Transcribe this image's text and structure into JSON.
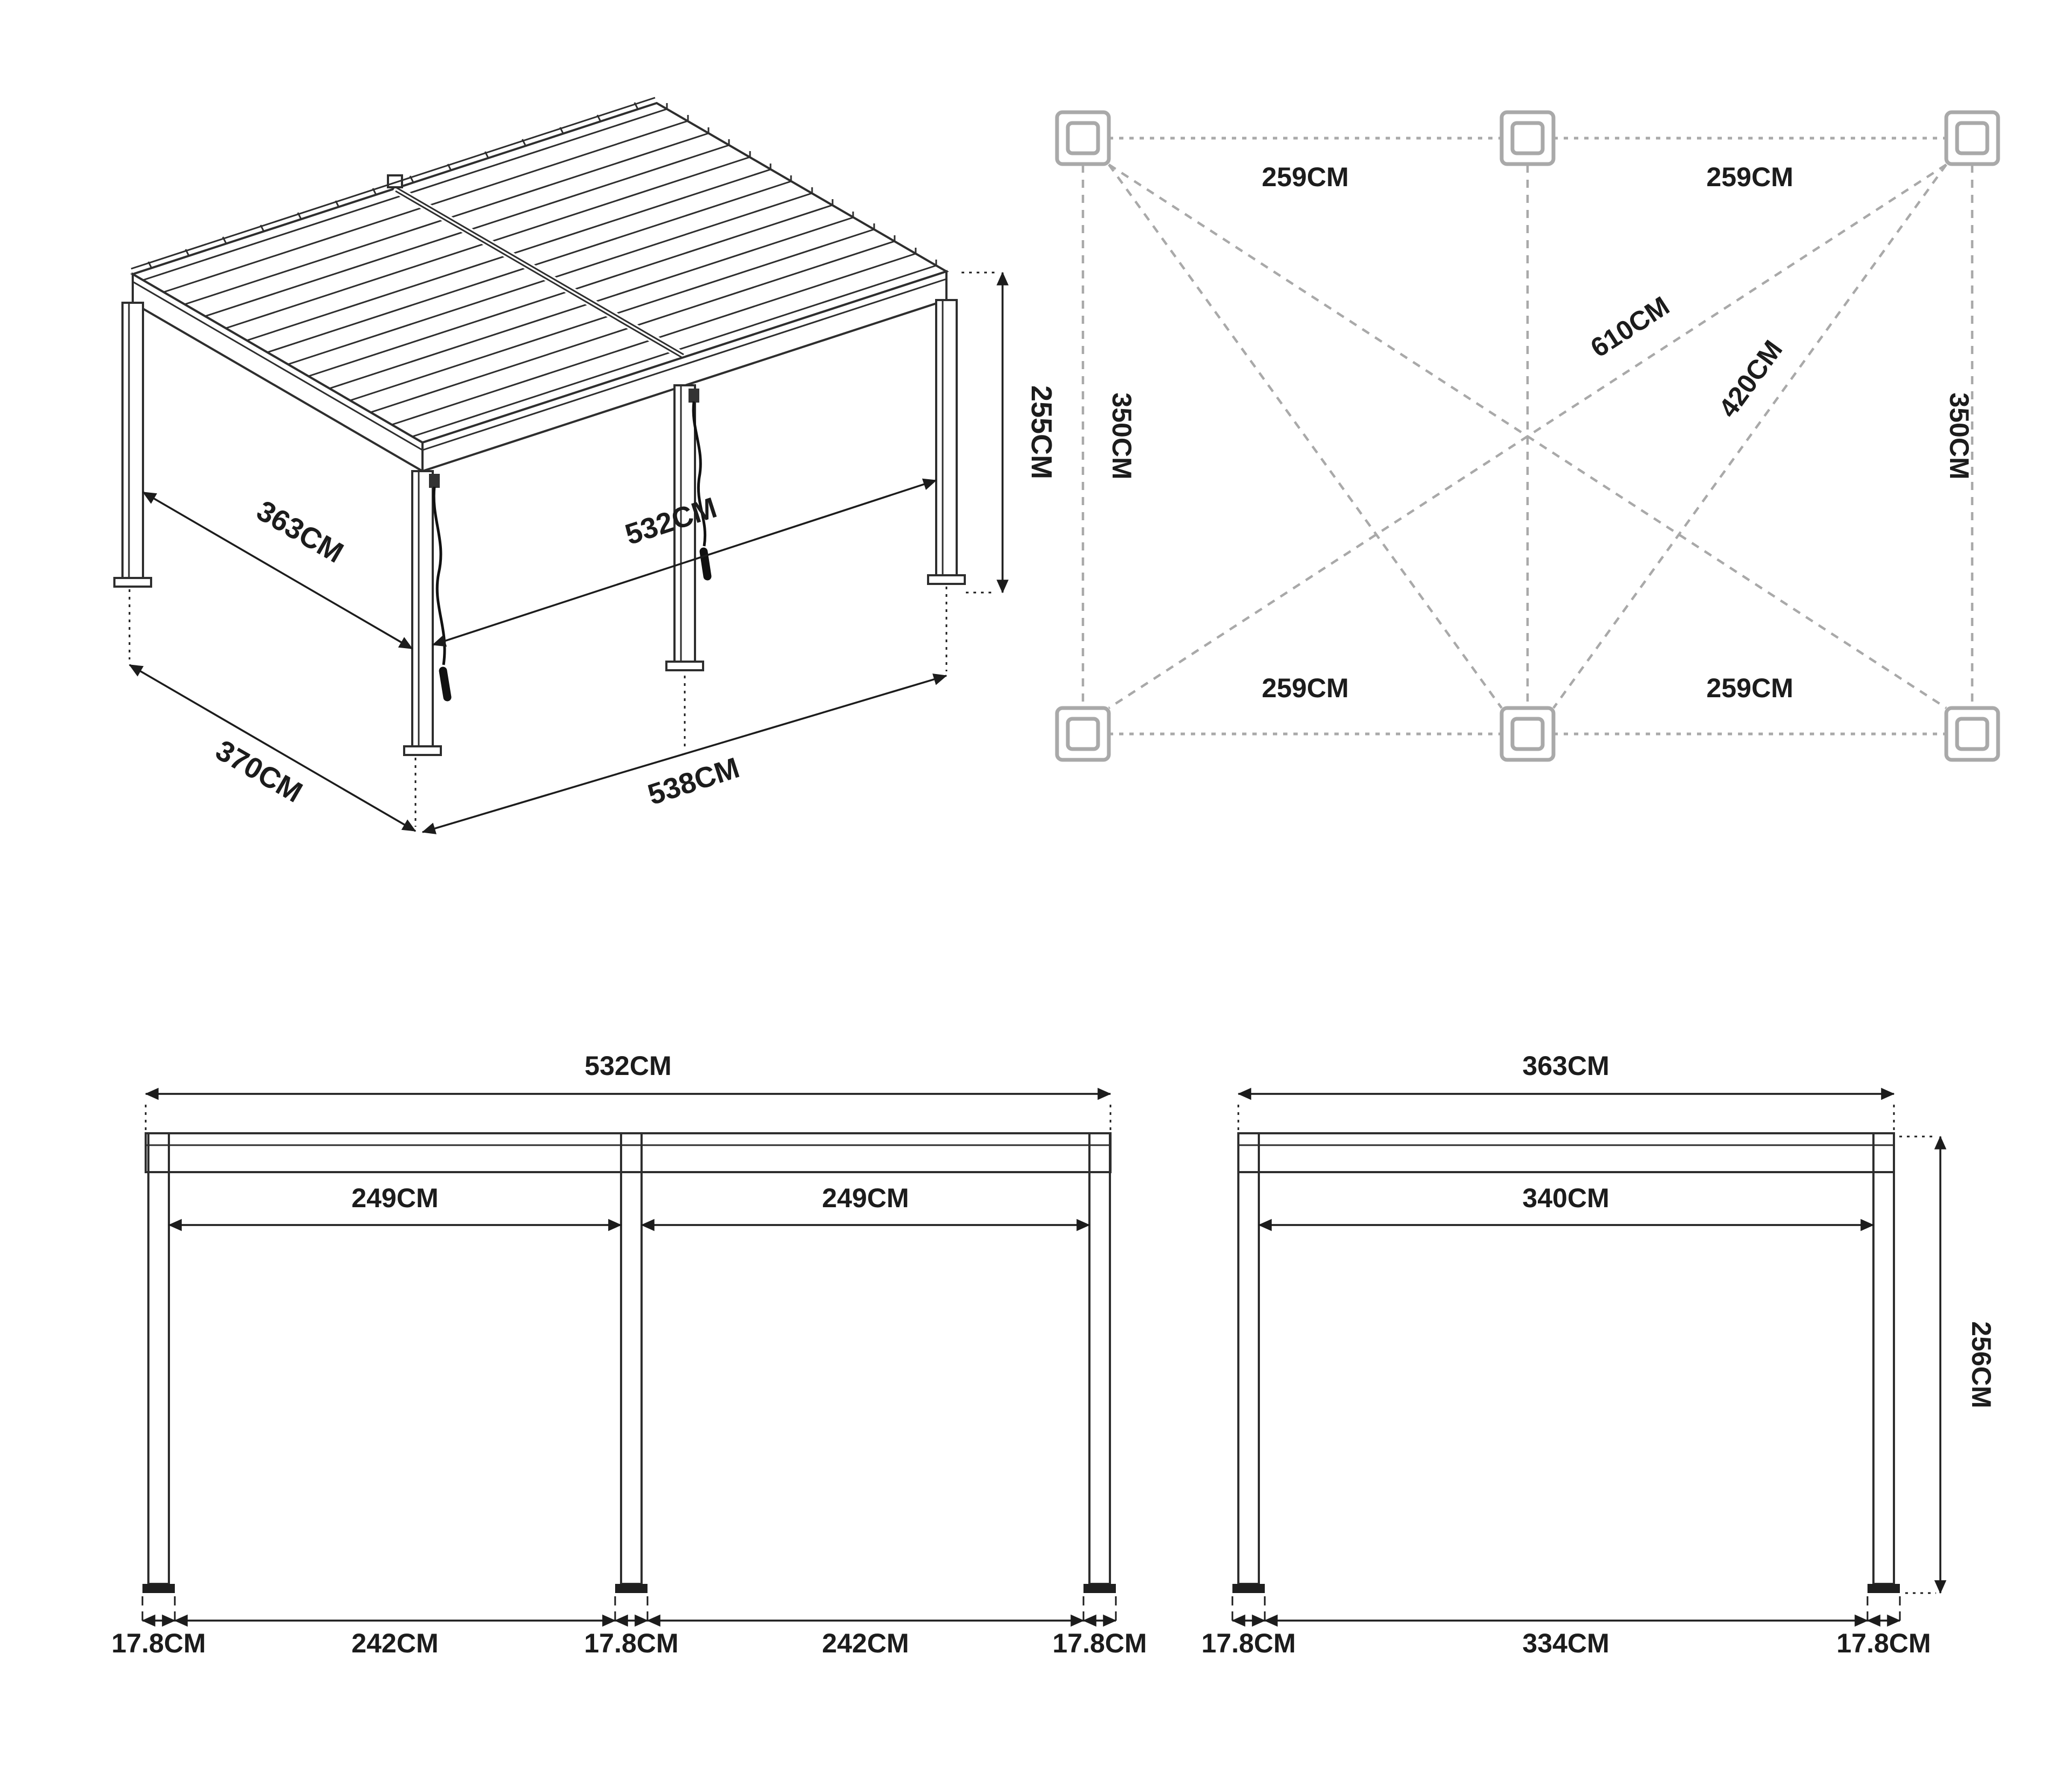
{
  "title": "Pergola dimension drawing",
  "colors": {
    "line": "#2e2e2e",
    "dimension": "#1c1c1c",
    "plan_gray": "#a9a9a9",
    "background": "#ffffff"
  },
  "iso": {
    "dim_363": "363CM",
    "dim_370": "370CM",
    "dim_532": "532CM",
    "dim_538": "538CM",
    "dim_255": "255CM"
  },
  "plan": {
    "span_top_left": "259CM",
    "span_top_right": "259CM",
    "span_bottom_left": "259CM",
    "span_bottom_right": "259CM",
    "side_left": "350CM",
    "side_right": "350CM",
    "diag_long": "610CM",
    "diag_short": "420CM"
  },
  "front": {
    "overall": "532CM",
    "bay_left": "249CM",
    "bay_right": "249CM",
    "foot_a": "17.8CM",
    "span_a": "242CM",
    "foot_b": "17.8CM",
    "span_b": "242CM",
    "foot_c": "17.8CM"
  },
  "side": {
    "overall": "363CM",
    "inner": "340CM",
    "height": "256CM",
    "foot_a": "17.8CM",
    "span": "334CM",
    "foot_b": "17.8CM"
  }
}
